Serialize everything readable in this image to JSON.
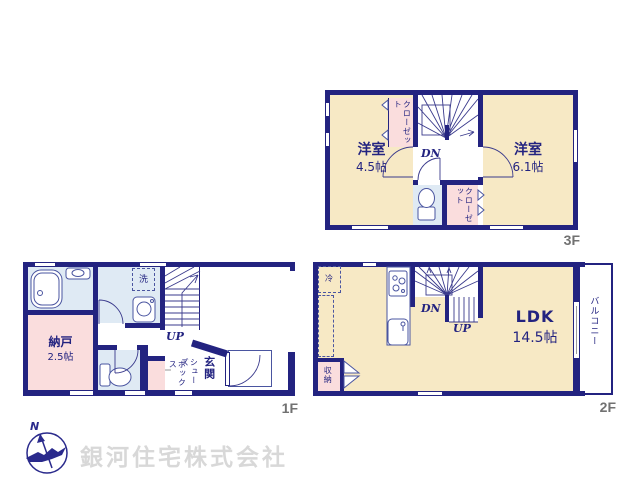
{
  "colors": {
    "wall": "#232380",
    "room_cream": "#f7e9c5",
    "room_pink": "#fadddd",
    "room_blue": "#dfeaf4",
    "floor_label_gray": "#717171",
    "watermark_gray": "#d8d8d8"
  },
  "floor3": {
    "label": "3F",
    "room_left": {
      "name": "洋室",
      "size": "4.5帖"
    },
    "room_right": {
      "name": "洋室",
      "size": "6.1帖"
    },
    "closet_top": {
      "label": "クローゼット"
    },
    "closet_bottom": {
      "label": "クローゼット"
    },
    "stairs": {
      "down": "DN"
    }
  },
  "floor2": {
    "label": "2F",
    "ldk": {
      "name": "LDK",
      "size": "14.5帖"
    },
    "balcony": {
      "label": "バルコニー"
    },
    "storage": {
      "label": "収納"
    },
    "fridge": {
      "label": "冷"
    },
    "stairs": {
      "down": "DN",
      "up": "UP"
    }
  },
  "floor1": {
    "label": "1F",
    "storage": {
      "name": "納戸",
      "size": "2.5帖"
    },
    "laundry": {
      "label": "洗"
    },
    "entrance": {
      "label": "玄関"
    },
    "shoe_box": {
      "line1": "シューズ",
      "line2": "ボックス"
    },
    "stairs": {
      "up": "UP"
    }
  },
  "footer": {
    "company": "銀河住宅株式会社",
    "compass_north": "N"
  }
}
